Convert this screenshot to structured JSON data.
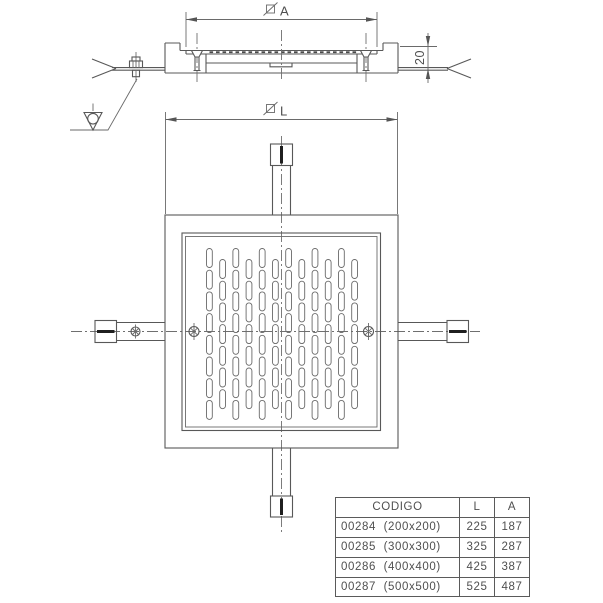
{
  "drawing_type": "technical drawing - square floor drain grate, section and plan views",
  "colors": {
    "line": "#585858",
    "dark_accent": "#1f1f1f",
    "text": "#4f4f4f",
    "background": "#ffffff"
  },
  "icons": {
    "square_section_symbol": "slashed-square (square section dimension symbol)",
    "surface_finish_symbol": "inverted-triangle-with-circle (machining/finish symbol)",
    "break_symbol": "angled break lines",
    "anchor_bolt_symbol": "hatched circle with cross"
  },
  "dims": {
    "a_label": "A",
    "l_label": "L",
    "height_label": "20"
  },
  "table": {
    "headers": {
      "codigo": "CODIGO",
      "l": "L",
      "a": "A"
    },
    "rows": [
      {
        "codigo": "00284  (200x200)",
        "l": "225",
        "a": "187"
      },
      {
        "codigo": "00285  (300x300)",
        "l": "325",
        "a": "287"
      },
      {
        "codigo": "00286  (400x400)",
        "l": "425",
        "a": "387"
      },
      {
        "codigo": "00287  (500x500)",
        "l": "525",
        "a": "487"
      }
    ]
  }
}
